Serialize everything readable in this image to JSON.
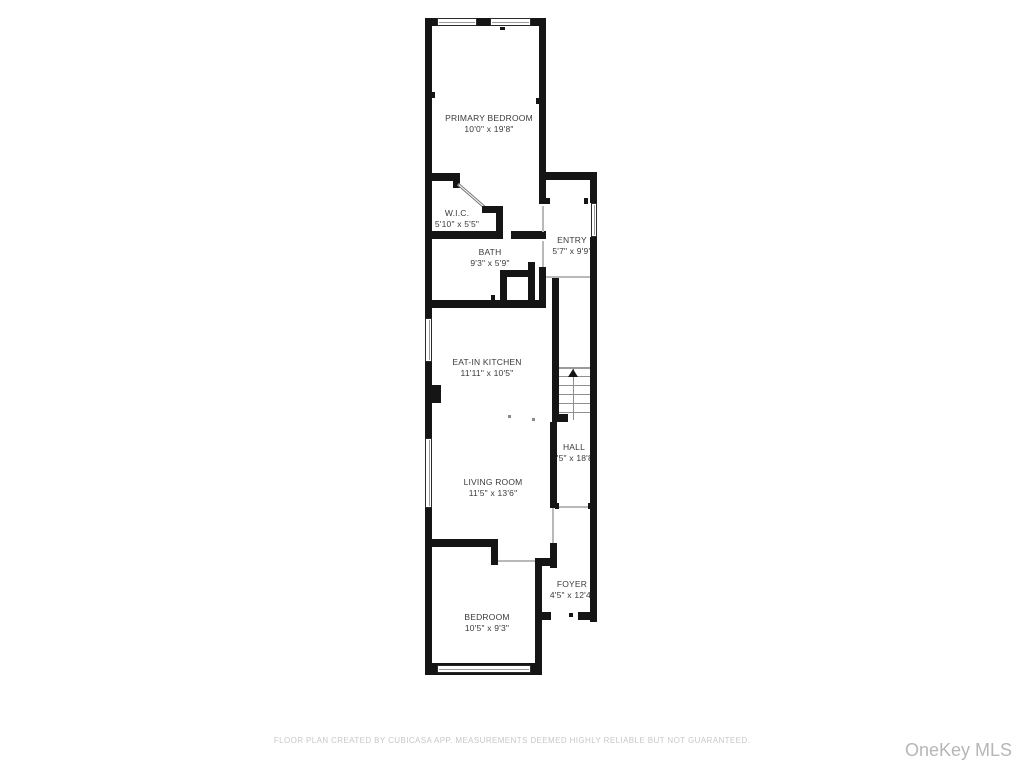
{
  "title": "Floor plan",
  "rooms": [
    {
      "id": "primary-bedroom",
      "name": "PRIMARY BEDROOM",
      "dims": "10'0\" x 19'8\""
    },
    {
      "id": "wic",
      "name": "W.I.C.",
      "dims": "5'10\" x 5'5\""
    },
    {
      "id": "bath",
      "name": "BATH",
      "dims": "9'3\" x 5'9\""
    },
    {
      "id": "entry",
      "name": "ENTRY",
      "dims": "5'7\" x 9'9\""
    },
    {
      "id": "eat-in-kitchen",
      "name": "EAT-IN KITCHEN",
      "dims": "11'11\" x 10'5\""
    },
    {
      "id": "hall",
      "name": "HALL",
      "dims": "3'5\" x 18'8\""
    },
    {
      "id": "living-room",
      "name": "LIVING ROOM",
      "dims": "11'5\" x 13'6\""
    },
    {
      "id": "bedroom",
      "name": "BEDROOM",
      "dims": "10'5\" x 9'3\""
    },
    {
      "id": "foyer",
      "name": "FOYER",
      "dims": "4'5\" x 12'4\""
    }
  ],
  "footer": {
    "disclaimer": "FLOOR PLAN CREATED BY CUBICASA APP. MEASUREMENTS DEEMED HIGHLY RELIABLE BUT NOT GUARANTEED."
  },
  "watermark": {
    "text": "OneKey MLS"
  },
  "colors": {
    "wall": "#151515",
    "label_text": "#3a3a3a",
    "disclaimer_text": "#c8c8c8",
    "watermark_text": "#b6b6b6",
    "background": "#ffffff"
  }
}
